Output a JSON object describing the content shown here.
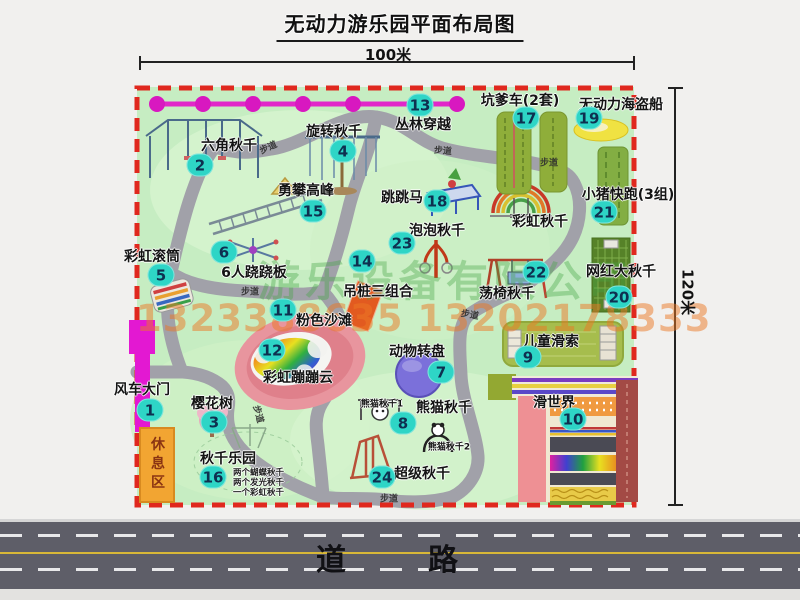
{
  "title": "无动力游乐园平面布局图",
  "dimensions": {
    "top": "100米",
    "right": "120米"
  },
  "road": {
    "label": "道　路"
  },
  "watermark": {
    "company": "游乐设备有限公司",
    "phone": "1323388635 13202178333"
  },
  "rest_area": {
    "label": "休息区"
  },
  "map": {
    "attractions": [
      {
        "num": "1",
        "label": "风车大门",
        "lx": 142,
        "ly": 389,
        "bx": 150,
        "by": 410
      },
      {
        "num": "2",
        "label": "六角秋千",
        "lx": 229,
        "ly": 145,
        "bx": 200,
        "by": 165
      },
      {
        "num": "3",
        "label": "樱花树",
        "lx": 212,
        "ly": 403,
        "bx": 214,
        "by": 422
      },
      {
        "num": "4",
        "label": "旋转秋千",
        "lx": 334,
        "ly": 131,
        "bx": 343,
        "by": 151
      },
      {
        "num": "5",
        "label": "彩虹滚筒",
        "lx": 152,
        "ly": 256,
        "bx": 161,
        "by": 275
      },
      {
        "num": "6",
        "label": "6人跷跷板",
        "lx": 254,
        "ly": 272,
        "bx": 224,
        "by": 252
      },
      {
        "num": "7",
        "label": "动物转盘",
        "lx": 417,
        "ly": 351,
        "bx": 441,
        "by": 372
      },
      {
        "num": "8",
        "label": "熊猫秋千",
        "lx": 444,
        "ly": 407,
        "bx": 403,
        "by": 423
      },
      {
        "num": "9",
        "label": "儿童滑索",
        "lx": 551,
        "ly": 341,
        "bx": 528,
        "by": 357
      },
      {
        "num": "10",
        "label": "滑世界",
        "lx": 554,
        "ly": 402,
        "bx": 573,
        "by": 419
      },
      {
        "num": "11",
        "label": "粉色沙滩",
        "lx": 324,
        "ly": 320,
        "bx": 283,
        "by": 310
      },
      {
        "num": "12",
        "label": "彩虹蹦蹦云",
        "lx": 298,
        "ly": 377,
        "bx": 272,
        "by": 350
      },
      {
        "num": "13",
        "label": "丛林穿越",
        "lx": 423,
        "ly": 124,
        "bx": 420,
        "by": 105
      },
      {
        "num": "14",
        "label": "吊桩三组合",
        "lx": 378,
        "ly": 291,
        "bx": 362,
        "by": 261
      },
      {
        "num": "15",
        "label": "勇攀高峰",
        "lx": 306,
        "ly": 190,
        "bx": 313,
        "by": 211
      },
      {
        "num": "16",
        "label": "秋千乐园",
        "lx": 228,
        "ly": 458,
        "bx": 213,
        "by": 477
      },
      {
        "num": "17",
        "label": "坑爹车(2套)",
        "lx": 520,
        "ly": 100,
        "bx": 526,
        "by": 118
      },
      {
        "num": "18",
        "label": "跳跳马",
        "lx": 402,
        "ly": 197,
        "bx": 437,
        "by": 201
      },
      {
        "num": "19",
        "label": "无动力海盗船",
        "lx": 621,
        "ly": 104,
        "bx": 589,
        "by": 118
      },
      {
        "num": "20",
        "label": "网红大秋千",
        "lx": 621,
        "ly": 271,
        "bx": 619,
        "by": 297
      },
      {
        "num": "21",
        "label": "小猪快跑(3组)",
        "lx": 628,
        "ly": 194,
        "bx": 604,
        "by": 212
      },
      {
        "num": "22",
        "label": "荡椅秋千",
        "lx": 507,
        "ly": 293,
        "bx": 536,
        "by": 272
      },
      {
        "num": "23",
        "label": "泡泡秋千",
        "lx": 437,
        "ly": 230,
        "bx": 402,
        "by": 243
      },
      {
        "num": "24",
        "label": "超级秋千",
        "lx": 422,
        "ly": 473,
        "bx": 382,
        "by": 477
      }
    ],
    "extra_labels": [
      {
        "text": "彩虹秋千",
        "x": 540,
        "y": 221,
        "size": 14
      },
      {
        "text": "熊猫秋千1",
        "x": 382,
        "y": 403,
        "size": 9
      },
      {
        "text": "熊猫秋千2",
        "x": 449,
        "y": 446,
        "size": 9
      }
    ],
    "path_labels": [
      {
        "text": "步道",
        "x": 268,
        "y": 147,
        "rot": -25
      },
      {
        "text": "步道",
        "x": 443,
        "y": 150,
        "rot": 5
      },
      {
        "text": "步道",
        "x": 549,
        "y": 162,
        "rot": 0
      },
      {
        "text": "步道",
        "x": 250,
        "y": 291,
        "rot": 0
      },
      {
        "text": "步道",
        "x": 259,
        "y": 414,
        "rot": 75
      },
      {
        "text": "步道",
        "x": 389,
        "y": 498,
        "rot": 0
      },
      {
        "text": "步道",
        "x": 470,
        "y": 314,
        "rot": 10
      }
    ],
    "swing_park_notes": [
      "两个蝴蝶秋千",
      "两个发光秋千",
      "一个彩虹秋千"
    ]
  }
}
